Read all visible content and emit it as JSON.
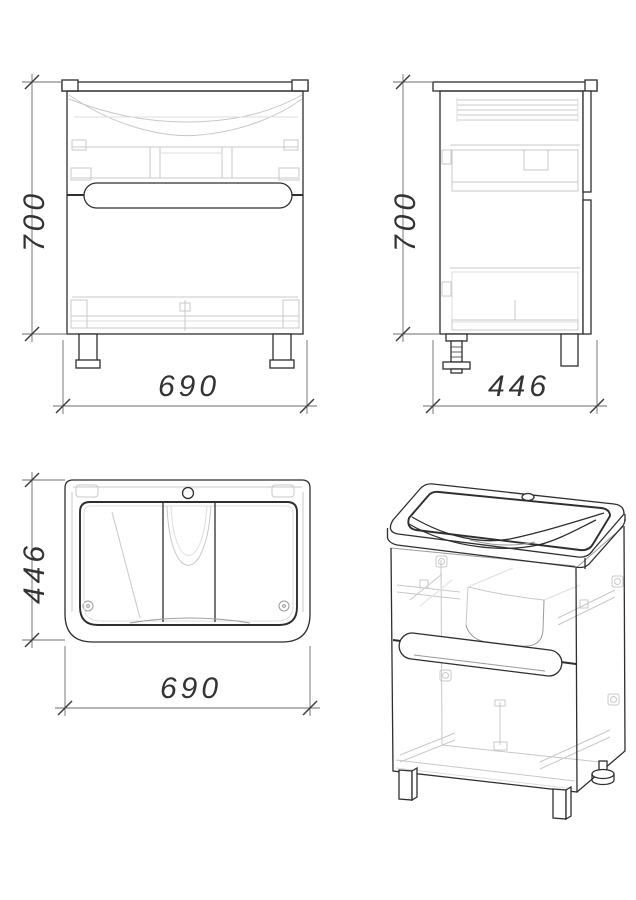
{
  "drawing": {
    "background": "#ffffff",
    "line_color": "#2e2e2e",
    "faint_line_color": "#c8c8c8",
    "dimension_line_color": "#6b6b6b",
    "dimension_text_color": "#333333"
  },
  "views": {
    "front": {
      "height_mm": "700",
      "width_mm": "690"
    },
    "side": {
      "height_mm": "700",
      "depth_mm": "446"
    },
    "top": {
      "depth_mm": "446",
      "width_mm": "690"
    }
  }
}
